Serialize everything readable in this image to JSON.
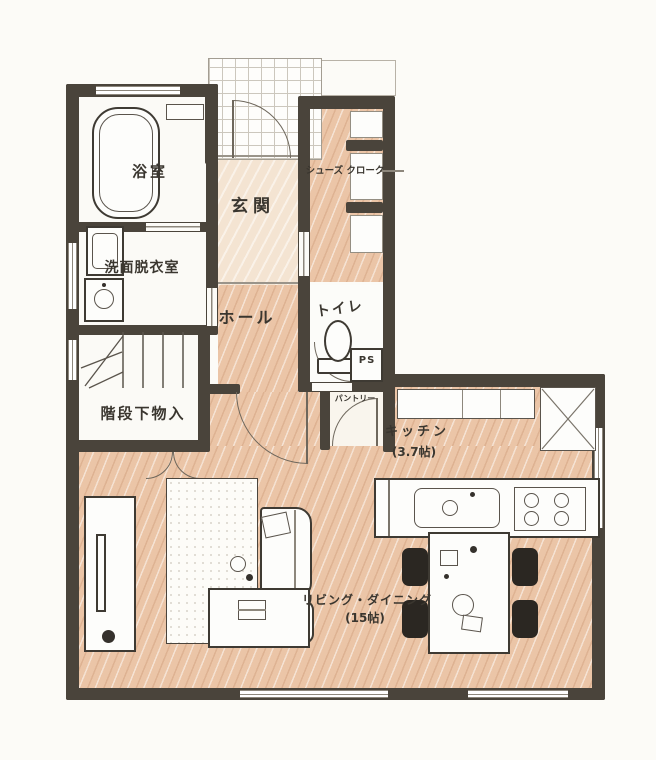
{
  "plan": {
    "kind": "floor-plan-sketch",
    "rooms": {
      "bath": {
        "label": "浴室"
      },
      "washroom": {
        "label": "洗面脱衣室"
      },
      "entrance": {
        "label": "玄関"
      },
      "shoes_closet": {
        "label": "シューズ クローク"
      },
      "hall": {
        "label": "ホール"
      },
      "toilet": {
        "label": "トイレ"
      },
      "under_stairs": {
        "label": "階段下物入"
      },
      "pantry": {
        "label": "パントリー"
      },
      "pipe_space": {
        "label": "PS"
      },
      "kitchen": {
        "label": "キッチン",
        "size": "(3.7帖)"
      },
      "living_dining": {
        "label": "リビング・ダイニング",
        "size": "(15帖)"
      }
    }
  },
  "colors": {
    "wall": "#4a443b",
    "wood": "#ebc5a7",
    "entrance_floor": "#f4e4d2",
    "ink": "#3a362f",
    "line": "#6e675c",
    "background": "#fcfbf7",
    "chair": "#2b2722"
  }
}
